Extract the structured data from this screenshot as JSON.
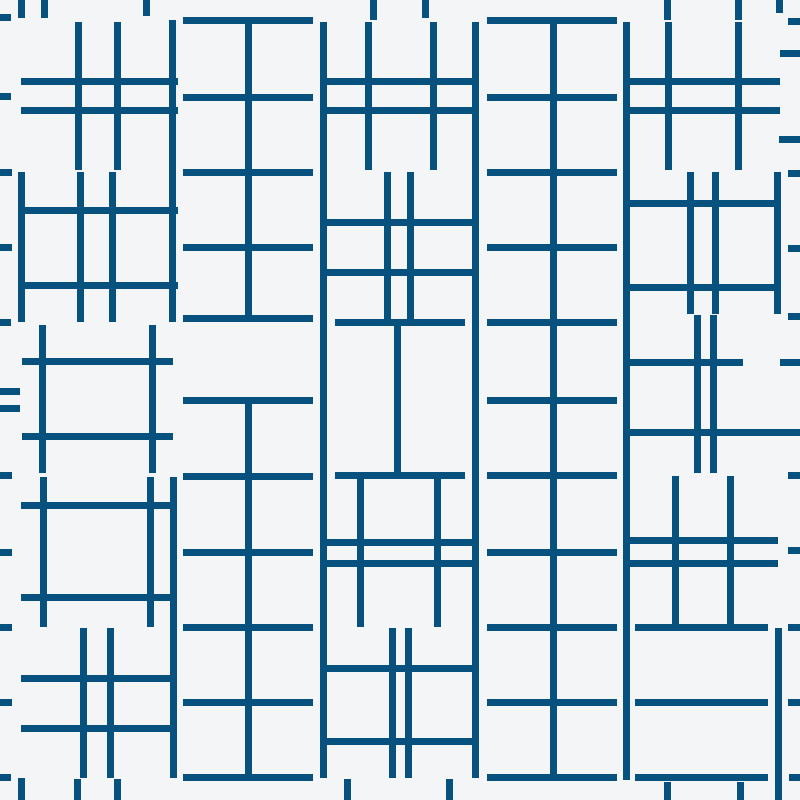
{
  "canvas": {
    "width": 800,
    "height": 800,
    "background_color": "#F4F5F6",
    "line_color": "#07517F",
    "line_thickness": 7,
    "description": "Abstract generative pattern of dark blue axis-aligned line segments forming hash (#) and ladder motifs on an off-white background, arranged in five vertical columns with small tick marks along all four edges"
  },
  "segments": {
    "horizontal": [
      {
        "x": 0,
        "y": 14,
        "w": 11,
        "name": "left-edge-tick"
      },
      {
        "x": 0,
        "y": 93,
        "w": 11,
        "name": "left-edge-tick"
      },
      {
        "x": 0,
        "y": 169,
        "w": 12,
        "name": "left-edge-tick"
      },
      {
        "x": 0,
        "y": 244,
        "w": 12,
        "name": "left-edge-tick"
      },
      {
        "x": 0,
        "y": 319,
        "w": 11,
        "name": "left-edge-tick"
      },
      {
        "x": 0,
        "y": 388,
        "w": 20,
        "name": "left-edge-tick"
      },
      {
        "x": 0,
        "y": 405,
        "w": 20,
        "name": "left-edge-tick"
      },
      {
        "x": 0,
        "y": 472,
        "w": 12,
        "name": "left-edge-tick"
      },
      {
        "x": 0,
        "y": 549,
        "w": 12,
        "name": "left-edge-tick"
      },
      {
        "x": 0,
        "y": 624,
        "w": 12,
        "name": "left-edge-tick"
      },
      {
        "x": 0,
        "y": 699,
        "w": 12,
        "name": "left-edge-tick"
      },
      {
        "x": 0,
        "y": 774,
        "w": 11,
        "name": "left-edge-tick"
      },
      {
        "x": 788,
        "y": 18,
        "w": 12,
        "name": "right-edge-tick"
      },
      {
        "x": 780,
        "y": 50,
        "w": 20,
        "name": "right-edge-tick"
      },
      {
        "x": 779,
        "y": 136,
        "w": 21,
        "name": "right-edge-tick"
      },
      {
        "x": 788,
        "y": 170,
        "w": 12,
        "name": "right-edge-tick"
      },
      {
        "x": 788,
        "y": 245,
        "w": 12,
        "name": "right-edge-tick"
      },
      {
        "x": 788,
        "y": 313,
        "w": 12,
        "name": "right-edge-tick"
      },
      {
        "x": 780,
        "y": 359,
        "w": 20,
        "name": "right-edge-tick"
      },
      {
        "x": 788,
        "y": 472,
        "w": 12,
        "name": "right-edge-tick"
      },
      {
        "x": 788,
        "y": 547,
        "w": 12,
        "name": "right-edge-tick"
      },
      {
        "x": 788,
        "y": 624,
        "w": 12,
        "name": "right-edge-tick"
      },
      {
        "x": 788,
        "y": 699,
        "w": 12,
        "name": "right-edge-tick"
      },
      {
        "x": 789,
        "y": 774,
        "w": 11,
        "name": "right-edge-tick"
      },
      {
        "x": 21,
        "y": 78,
        "w": 157,
        "name": "col1-hash-a-bar"
      },
      {
        "x": 21,
        "y": 107,
        "w": 157,
        "name": "col1-hash-a-bar"
      },
      {
        "x": 18,
        "y": 207,
        "w": 160,
        "name": "col1-hash-b-bar"
      },
      {
        "x": 18,
        "y": 282,
        "w": 160,
        "name": "col1-hash-b-bar"
      },
      {
        "x": 22,
        "y": 358,
        "w": 151,
        "name": "col1-hash-c-bar"
      },
      {
        "x": 22,
        "y": 433,
        "w": 151,
        "name": "col1-hash-c-bar"
      },
      {
        "x": 21,
        "y": 502,
        "w": 152,
        "name": "col1-hash-d-bar"
      },
      {
        "x": 21,
        "y": 594,
        "w": 152,
        "name": "col1-hash-d-bar"
      },
      {
        "x": 21,
        "y": 675,
        "w": 152,
        "name": "col1-hash-e-bar"
      },
      {
        "x": 21,
        "y": 725,
        "w": 152,
        "name": "col1-hash-e-bar"
      },
      {
        "x": 183,
        "y": 17,
        "w": 130,
        "name": "col2-upper-ladder-rung"
      },
      {
        "x": 183,
        "y": 94,
        "w": 130,
        "name": "col2-upper-ladder-rung"
      },
      {
        "x": 183,
        "y": 169,
        "w": 130,
        "name": "col2-upper-ladder-rung"
      },
      {
        "x": 183,
        "y": 244,
        "w": 130,
        "name": "col2-upper-ladder-rung"
      },
      {
        "x": 183,
        "y": 315,
        "w": 130,
        "name": "col2-upper-ladder-rung"
      },
      {
        "x": 183,
        "y": 397,
        "w": 130,
        "name": "col2-lower-ladder-rung"
      },
      {
        "x": 183,
        "y": 473,
        "w": 130,
        "name": "col2-lower-ladder-rung"
      },
      {
        "x": 183,
        "y": 549,
        "w": 130,
        "name": "col2-lower-ladder-rung"
      },
      {
        "x": 183,
        "y": 624,
        "w": 130,
        "name": "col2-lower-ladder-rung"
      },
      {
        "x": 183,
        "y": 699,
        "w": 130,
        "name": "col2-lower-ladder-rung"
      },
      {
        "x": 183,
        "y": 774,
        "w": 130,
        "name": "col2-lower-ladder-rung"
      },
      {
        "x": 321,
        "y": 78,
        "w": 157,
        "name": "col3-hash-f-bar"
      },
      {
        "x": 321,
        "y": 107,
        "w": 157,
        "name": "col3-hash-f-bar"
      },
      {
        "x": 323,
        "y": 219,
        "w": 155,
        "name": "col3-hash-g-bar"
      },
      {
        "x": 323,
        "y": 269,
        "w": 155,
        "name": "col3-hash-g-bar"
      },
      {
        "x": 335,
        "y": 319,
        "w": 130,
        "name": "col3-ladder-h-rung"
      },
      {
        "x": 335,
        "y": 472,
        "w": 130,
        "name": "col3-ladder-h-rung"
      },
      {
        "x": 323,
        "y": 539,
        "w": 155,
        "name": "col3-hash-i-bar"
      },
      {
        "x": 323,
        "y": 560,
        "w": 155,
        "name": "col3-hash-i-bar"
      },
      {
        "x": 325,
        "y": 665,
        "w": 148,
        "name": "col3-hash-j-bar"
      },
      {
        "x": 325,
        "y": 738,
        "w": 148,
        "name": "col3-hash-j-bar"
      },
      {
        "x": 487,
        "y": 17,
        "w": 130,
        "name": "col4-ladder-rung"
      },
      {
        "x": 487,
        "y": 94,
        "w": 130,
        "name": "col4-ladder-rung"
      },
      {
        "x": 487,
        "y": 169,
        "w": 130,
        "name": "col4-ladder-rung"
      },
      {
        "x": 487,
        "y": 244,
        "w": 130,
        "name": "col4-ladder-rung"
      },
      {
        "x": 487,
        "y": 319,
        "w": 130,
        "name": "col4-ladder-rung"
      },
      {
        "x": 487,
        "y": 397,
        "w": 130,
        "name": "col4-ladder-rung"
      },
      {
        "x": 487,
        "y": 472,
        "w": 130,
        "name": "col4-ladder-rung"
      },
      {
        "x": 487,
        "y": 549,
        "w": 130,
        "name": "col4-ladder-rung"
      },
      {
        "x": 487,
        "y": 624,
        "w": 130,
        "name": "col4-ladder-rung"
      },
      {
        "x": 487,
        "y": 699,
        "w": 130,
        "name": "col4-ladder-rung"
      },
      {
        "x": 487,
        "y": 774,
        "w": 130,
        "name": "col4-ladder-rung"
      },
      {
        "x": 623,
        "y": 78,
        "w": 157,
        "name": "col5-hash-l-bar"
      },
      {
        "x": 623,
        "y": 107,
        "w": 157,
        "name": "col5-hash-l-bar"
      },
      {
        "x": 625,
        "y": 200,
        "w": 153,
        "name": "col5-hash-m-bar"
      },
      {
        "x": 625,
        "y": 284,
        "w": 153,
        "name": "col5-hash-m-bar"
      },
      {
        "x": 625,
        "y": 359,
        "w": 118,
        "name": "col5-hash-n-bar"
      },
      {
        "x": 625,
        "y": 429,
        "w": 175,
        "name": "col5-hash-n-bar"
      },
      {
        "x": 625,
        "y": 537,
        "w": 153,
        "name": "col5-hash-o-bar"
      },
      {
        "x": 625,
        "y": 560,
        "w": 153,
        "name": "col5-hash-o-bar"
      },
      {
        "x": 635,
        "y": 624,
        "w": 133,
        "name": "col5-ladder-p-rung"
      },
      {
        "x": 635,
        "y": 699,
        "w": 133,
        "name": "col5-ladder-p-rung"
      },
      {
        "x": 635,
        "y": 774,
        "w": 133,
        "name": "col5-ladder-p-rung"
      }
    ],
    "vertical": [
      {
        "x": 18,
        "y": 0,
        "h": 18,
        "name": "top-edge-tick"
      },
      {
        "x": 41,
        "y": 0,
        "h": 18,
        "name": "top-edge-tick"
      },
      {
        "x": 143,
        "y": 0,
        "h": 16,
        "name": "top-edge-tick"
      },
      {
        "x": 370,
        "y": 0,
        "h": 20,
        "name": "top-edge-tick"
      },
      {
        "x": 422,
        "y": 0,
        "h": 18,
        "name": "top-edge-tick"
      },
      {
        "x": 664,
        "y": 0,
        "h": 20,
        "name": "top-edge-tick"
      },
      {
        "x": 735,
        "y": 0,
        "h": 20,
        "name": "top-edge-tick"
      },
      {
        "x": 776,
        "y": 0,
        "h": 13,
        "name": "top-edge-tick"
      },
      {
        "x": 18,
        "y": 778,
        "h": 22,
        "name": "bottom-edge-tick"
      },
      {
        "x": 74,
        "y": 779,
        "h": 21,
        "name": "bottom-edge-tick"
      },
      {
        "x": 114,
        "y": 779,
        "h": 21,
        "name": "bottom-edge-tick"
      },
      {
        "x": 344,
        "y": 779,
        "h": 21,
        "name": "bottom-edge-tick"
      },
      {
        "x": 446,
        "y": 779,
        "h": 21,
        "name": "bottom-edge-tick"
      },
      {
        "x": 664,
        "y": 782,
        "h": 18,
        "name": "bottom-edge-tick"
      },
      {
        "x": 737,
        "y": 782,
        "h": 18,
        "name": "bottom-edge-tick"
      },
      {
        "x": 75,
        "y": 22,
        "h": 148,
        "name": "col1-hash-a-post"
      },
      {
        "x": 114,
        "y": 22,
        "h": 148,
        "name": "col1-hash-a-post"
      },
      {
        "x": 169,
        "y": 20,
        "h": 302,
        "name": "col1-long-vertical-upper"
      },
      {
        "x": 18,
        "y": 172,
        "h": 150,
        "name": "col1-hash-b-post"
      },
      {
        "x": 77,
        "y": 172,
        "h": 150,
        "name": "col1-hash-b-post"
      },
      {
        "x": 109,
        "y": 172,
        "h": 150,
        "name": "col1-hash-b-post"
      },
      {
        "x": 39,
        "y": 325,
        "h": 148,
        "name": "col1-hash-c-post"
      },
      {
        "x": 149,
        "y": 325,
        "h": 148,
        "name": "col1-hash-c-post"
      },
      {
        "x": 40,
        "y": 477,
        "h": 150,
        "name": "col1-hash-d-post"
      },
      {
        "x": 147,
        "y": 477,
        "h": 150,
        "name": "col1-hash-d-post"
      },
      {
        "x": 170,
        "y": 477,
        "h": 301,
        "name": "col1-long-vertical-lower"
      },
      {
        "x": 80,
        "y": 628,
        "h": 150,
        "name": "col1-hash-e-post"
      },
      {
        "x": 107,
        "y": 628,
        "h": 150,
        "name": "col1-hash-e-post"
      },
      {
        "x": 245,
        "y": 17,
        "h": 305,
        "name": "col2-upper-ladder-rail"
      },
      {
        "x": 245,
        "y": 397,
        "h": 384,
        "name": "col2-lower-ladder-rail"
      },
      {
        "x": 320,
        "y": 22,
        "h": 756,
        "name": "col2-col3-long-vertical"
      },
      {
        "x": 365,
        "y": 22,
        "h": 148,
        "name": "col3-hash-f-post"
      },
      {
        "x": 430,
        "y": 22,
        "h": 148,
        "name": "col3-hash-f-post"
      },
      {
        "x": 384,
        "y": 172,
        "h": 148,
        "name": "col3-hash-g-post"
      },
      {
        "x": 407,
        "y": 172,
        "h": 148,
        "name": "col3-hash-g-post"
      },
      {
        "x": 394,
        "y": 319,
        "h": 160,
        "name": "col3-ladder-h-rail"
      },
      {
        "x": 357,
        "y": 477,
        "h": 150,
        "name": "col3-hash-i-post"
      },
      {
        "x": 434,
        "y": 477,
        "h": 150,
        "name": "col3-hash-i-post"
      },
      {
        "x": 389,
        "y": 628,
        "h": 150,
        "name": "col3-hash-j-post"
      },
      {
        "x": 405,
        "y": 628,
        "h": 150,
        "name": "col3-hash-j-post"
      },
      {
        "x": 472,
        "y": 22,
        "h": 756,
        "name": "col3-col4-long-vertical"
      },
      {
        "x": 550,
        "y": 17,
        "h": 764,
        "name": "col4-ladder-rail"
      },
      {
        "x": 623,
        "y": 22,
        "h": 758,
        "name": "col4-col5-long-vertical"
      },
      {
        "x": 665,
        "y": 22,
        "h": 148,
        "name": "col5-hash-l-post"
      },
      {
        "x": 735,
        "y": 22,
        "h": 148,
        "name": "col5-hash-l-post"
      },
      {
        "x": 687,
        "y": 172,
        "h": 142,
        "name": "col5-hash-m-post"
      },
      {
        "x": 712,
        "y": 172,
        "h": 142,
        "name": "col5-hash-m-post"
      },
      {
        "x": 774,
        "y": 172,
        "h": 142,
        "name": "col5-hash-m-post"
      },
      {
        "x": 694,
        "y": 315,
        "h": 158,
        "name": "col5-hash-n-post"
      },
      {
        "x": 710,
        "y": 315,
        "h": 158,
        "name": "col5-hash-n-post"
      },
      {
        "x": 672,
        "y": 476,
        "h": 151,
        "name": "col5-hash-o-post"
      },
      {
        "x": 727,
        "y": 476,
        "h": 151,
        "name": "col5-hash-o-post"
      },
      {
        "x": 775,
        "y": 628,
        "h": 172,
        "name": "col5-ladder-p-rail"
      }
    ]
  }
}
